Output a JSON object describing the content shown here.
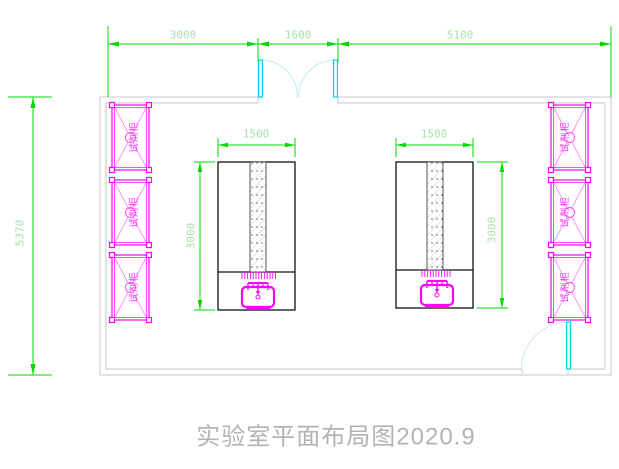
{
  "drawing": {
    "title": "实验室平面布局图2020.9",
    "type_note": "laboratory floor plan"
  },
  "dimensions": {
    "top": [
      "3000",
      "1600",
      "5100"
    ],
    "overall_height": "5370",
    "benches": [
      {
        "width": "1500",
        "depth": "3000"
      },
      {
        "width": "1500",
        "depth": "3000"
      }
    ]
  },
  "cabinets": {
    "left": [
      "试剂柜",
      "试剂柜",
      "试剂柜"
    ],
    "right": [
      "试剂柜",
      "试剂柜",
      "试剂柜"
    ]
  },
  "colors": {
    "dimension_line": "#00d800",
    "dimension_text": "#a9dfa9",
    "cabinet": "#ff00ff",
    "door_leaf": "#00d8e2",
    "door_arc": "#bfeef2",
    "wall": "#c8c8c8",
    "bench_outline": "#111111",
    "title_text": "#b3b3b3",
    "background": "#ffffff"
  }
}
